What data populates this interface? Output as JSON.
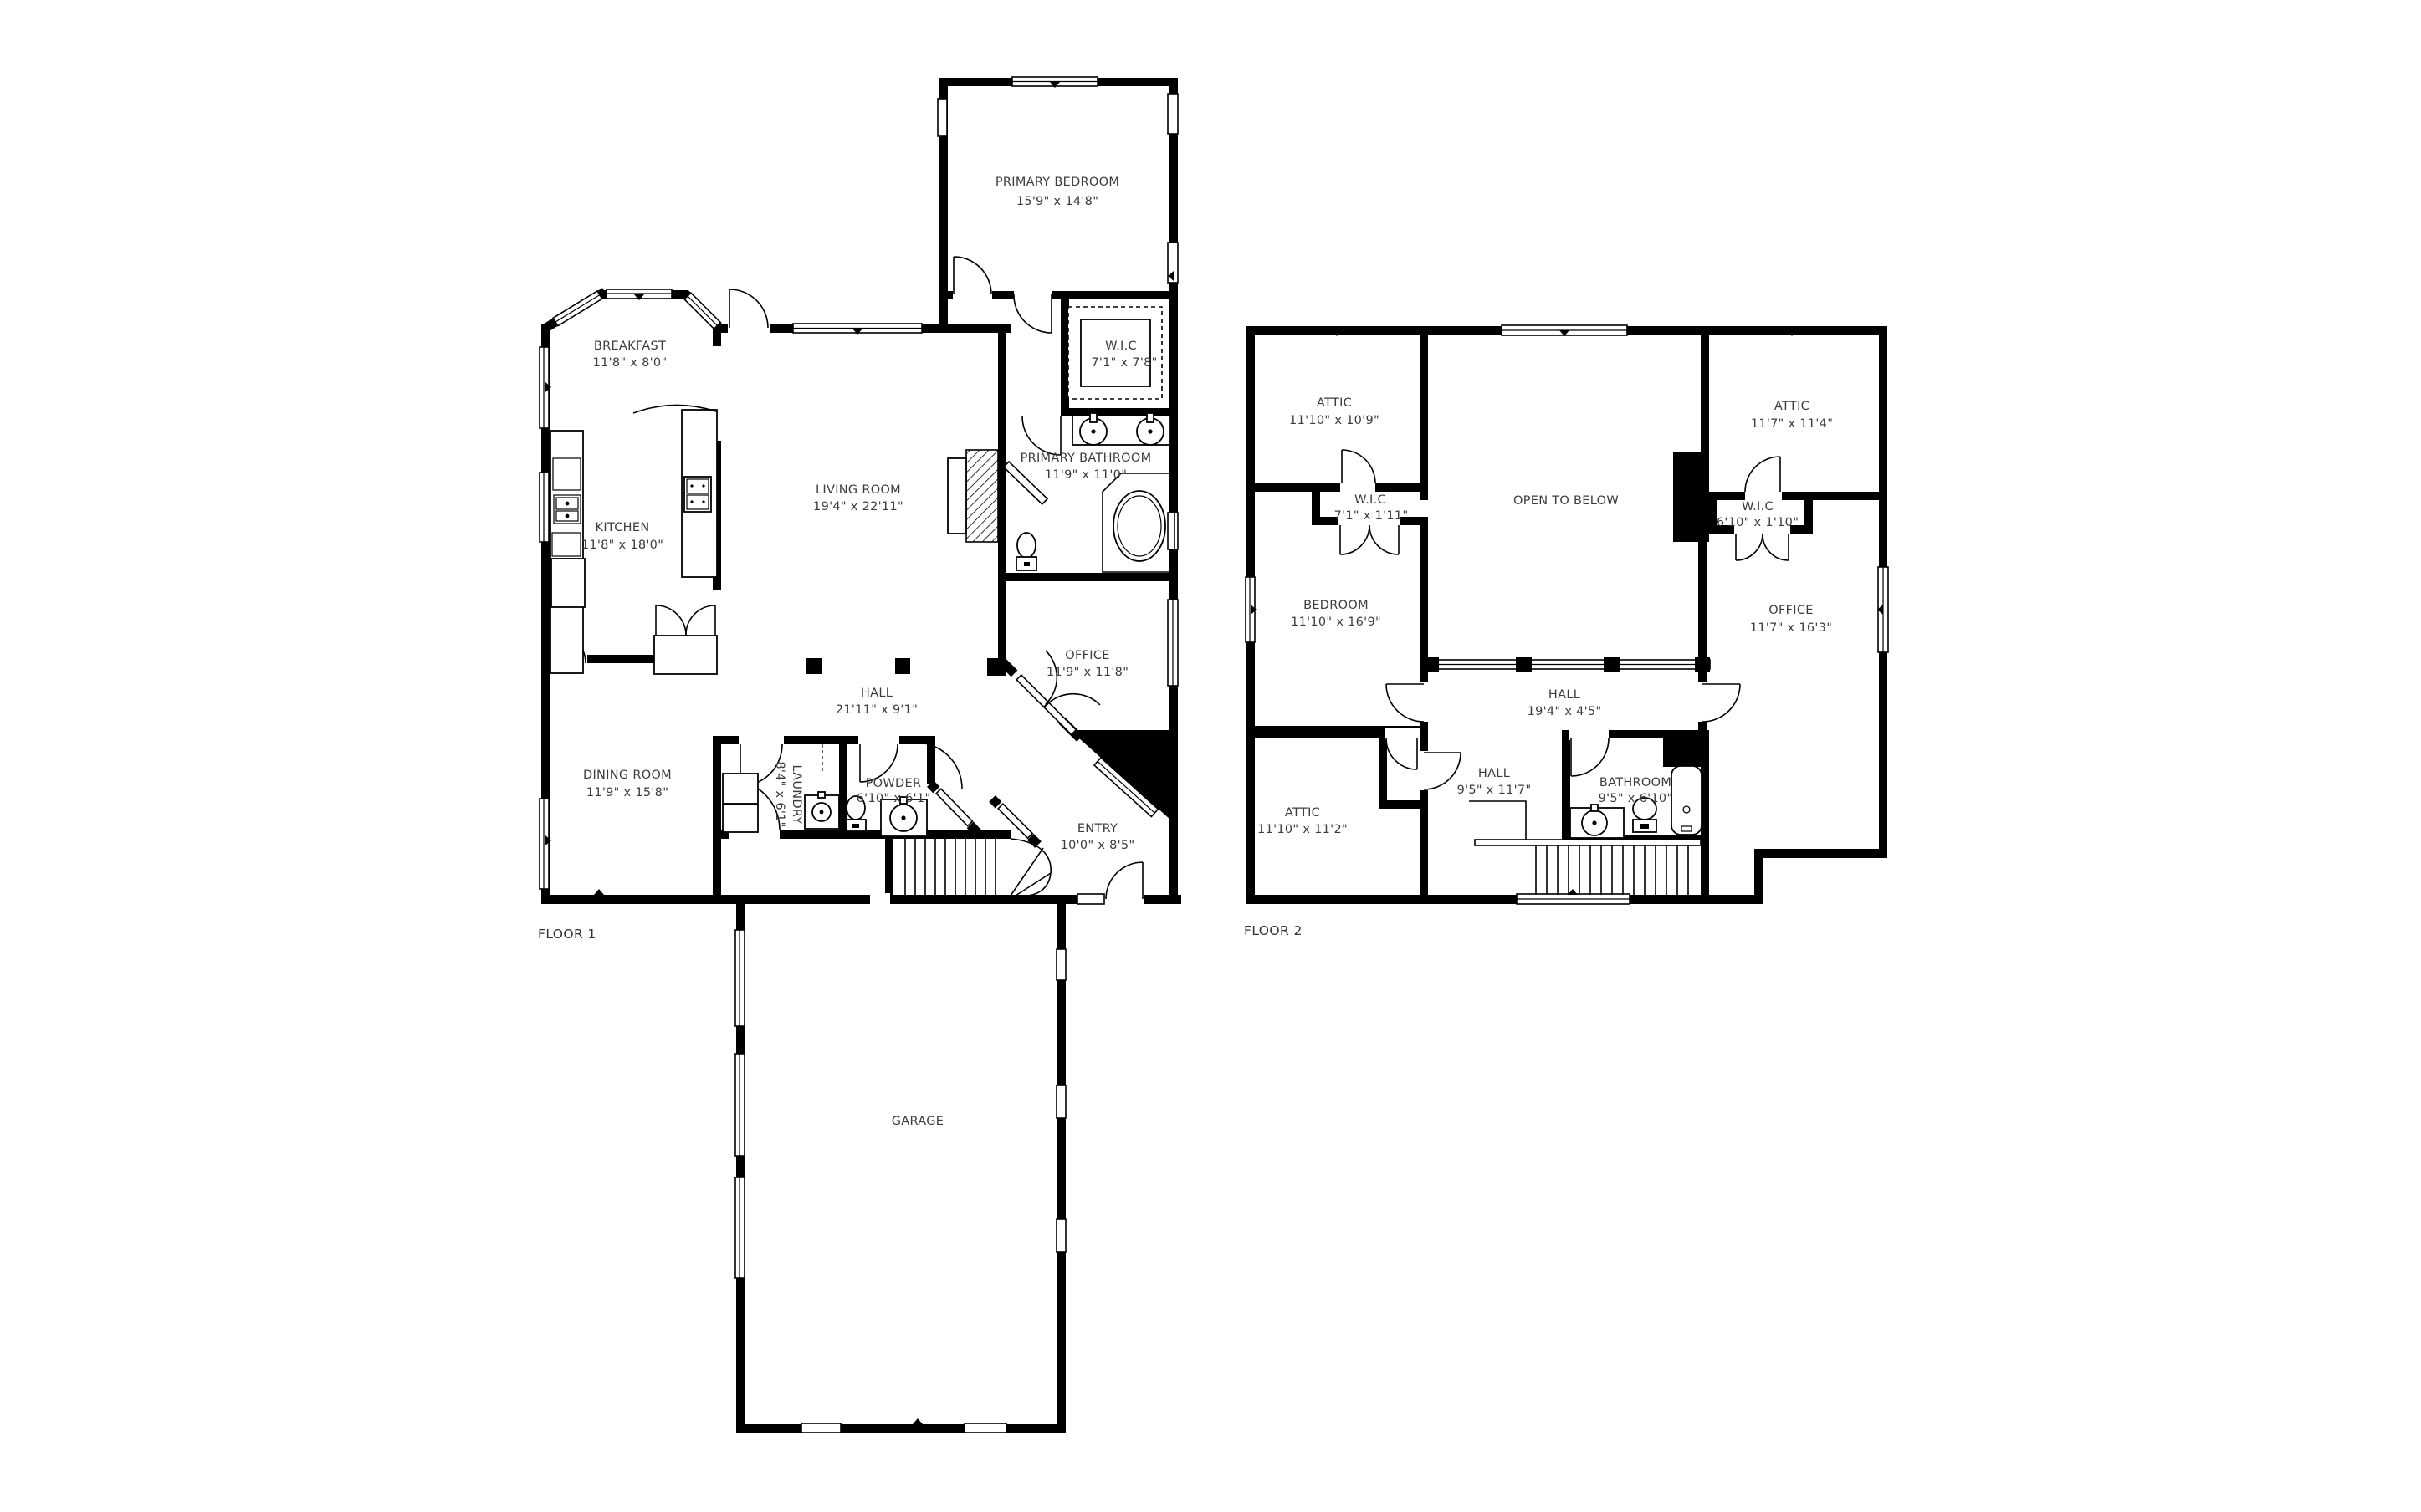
{
  "floor1": {
    "label": "FLOOR 1",
    "rooms": [
      {
        "name": "PRIMARY BEDROOM",
        "dims": "15'9\" x 14'8\""
      },
      {
        "name": "W.I.C",
        "dims": "7'1\" x 7'8\""
      },
      {
        "name": "PRIMARY BATHROOM",
        "dims": "11'9\" x 11'0\""
      },
      {
        "name": "BREAKFAST",
        "dims": "11'8\" x 8'0\""
      },
      {
        "name": "KITCHEN",
        "dims": "11'8\" x 18'0\""
      },
      {
        "name": "LIVING ROOM",
        "dims": "19'4\" x 22'11\""
      },
      {
        "name": "OFFICE",
        "dims": "11'9\" x 11'8\""
      },
      {
        "name": "HALL",
        "dims": "21'11\" x 9'1\""
      },
      {
        "name": "DINING ROOM",
        "dims": "11'9\" x 15'8\""
      },
      {
        "name": "LAUNDRY",
        "dims": "8'4\" x 6'1\""
      },
      {
        "name": "POWDER",
        "dims": "6'10\" x 6'1\""
      },
      {
        "name": "ENTRY",
        "dims": "10'0\" x 8'5\""
      },
      {
        "name": "GARAGE",
        "dims": ""
      }
    ]
  },
  "floor2": {
    "label": "FLOOR 2",
    "rooms": [
      {
        "name": "ATTIC",
        "dims": "11'10\" x 10'9\""
      },
      {
        "name": "OPEN TO BELOW",
        "dims": ""
      },
      {
        "name": "ATTIC",
        "dims": "11'7\" x 11'4\""
      },
      {
        "name": "W.I.C",
        "dims": "7'1\" x 1'11\""
      },
      {
        "name": "W.I.C",
        "dims": "6'10\" x 1'10\""
      },
      {
        "name": "BEDROOM",
        "dims": "11'10\" x 16'9\""
      },
      {
        "name": "OFFICE",
        "dims": "11'7\" x 16'3\""
      },
      {
        "name": "HALL",
        "dims": "19'4\" x 4'5\""
      },
      {
        "name": "HALL",
        "dims": "9'5\" x 11'7\""
      },
      {
        "name": "BATHROOM",
        "dims": "9'5\" x 6'10\""
      },
      {
        "name": "ATTIC",
        "dims": "11'10\" x 11'2\""
      }
    ]
  }
}
